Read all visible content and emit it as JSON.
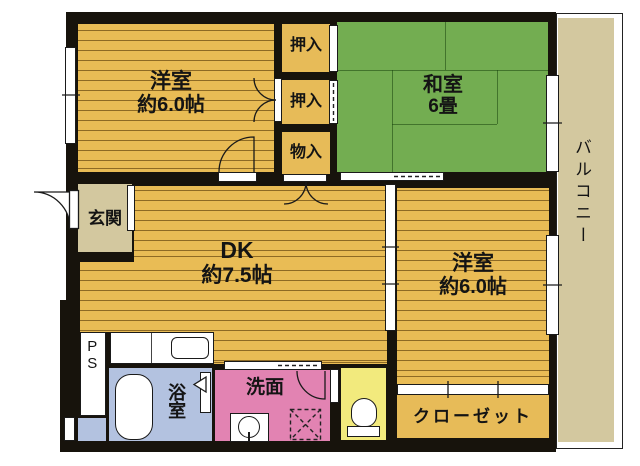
{
  "plan_type": "apartment-floor-plan",
  "rooms": {
    "bedroom_left": {
      "label": "洋室",
      "size": "約6.0帖"
    },
    "oshiire_1": {
      "label": "押入"
    },
    "oshiire_2": {
      "label": "押入"
    },
    "monoire": {
      "label": "物入"
    },
    "washitsu": {
      "label": "和室",
      "size": "6畳"
    },
    "balcony": {
      "label": "バルコニー"
    },
    "genkan": {
      "label": "玄関"
    },
    "dk": {
      "label": "DK",
      "size": "約7.5帖"
    },
    "bedroom_right": {
      "label": "洋室",
      "size": "約6.0帖"
    },
    "ps": {
      "label": "PS"
    },
    "bathroom": {
      "label": "浴室"
    },
    "washroom": {
      "label": "洗面"
    },
    "closet": {
      "label": "クローゼット"
    }
  },
  "colors": {
    "wall": "#17130c",
    "wood_floor": "#e9bc55",
    "closet_floor": "#e7bb58",
    "tatami": "#73ad51",
    "beige": "#d3c89f",
    "bath_blue": "#b3c2e0",
    "washroom_pink": "#e283b2",
    "toilet_yellow": "#f2ea7d"
  }
}
